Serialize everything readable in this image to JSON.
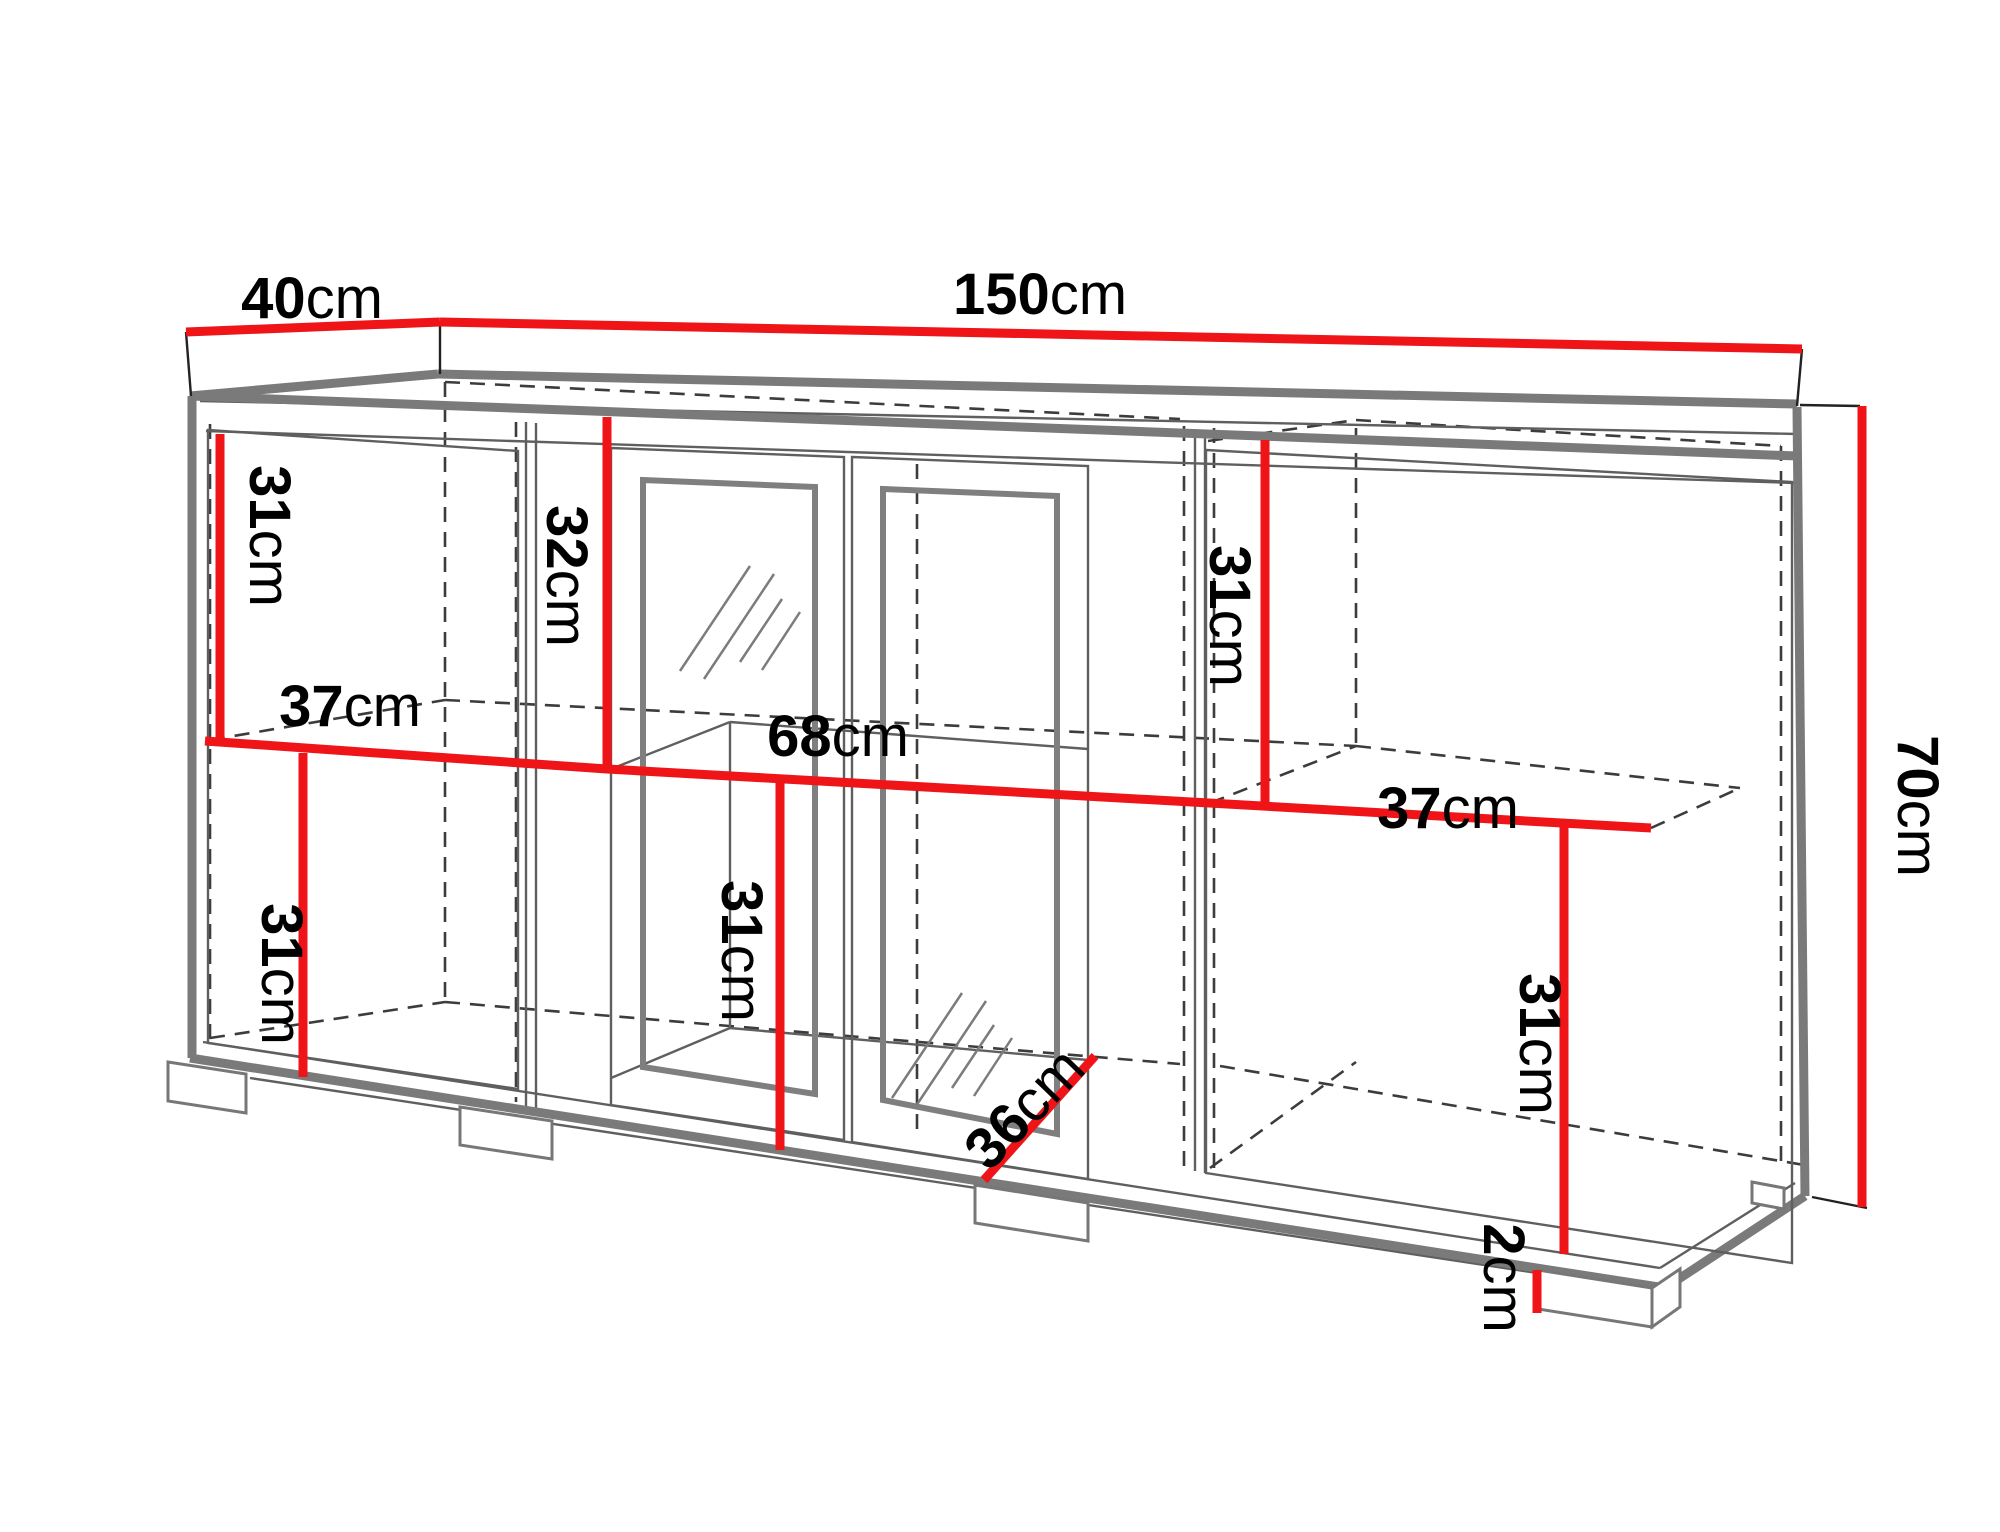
{
  "title": "Sideboard technical dimension diagram 150cm x 40cm x 70cm",
  "canvas": {
    "width": 2000,
    "height": 1500,
    "background": "#ffffff"
  },
  "colors": {
    "red": "#ee1417",
    "gray_thick": "#7a7a7a",
    "gray_thin": "#5f5f5f",
    "frame_thick": "#7f7f7f",
    "dash": "#3c3c3c",
    "tick": "#222222",
    "foot_stroke": "#777777",
    "text": "#000000"
  },
  "stroke": {
    "red_w": 9,
    "thick_w": 9,
    "thin_w": 2.4,
    "dash_w": 2.6,
    "dash_pattern": "15 10",
    "tick_w": 2.4,
    "frame_w": 6,
    "foot_w": 3,
    "font_size": 58
  },
  "dimensions": [
    {
      "id": "depth-top",
      "number": "40",
      "unit": "cm",
      "label": {
        "x": 272,
        "y": 302,
        "rotate": 0,
        "anchor": "middle"
      },
      "lines": [
        [
          146,
          316,
          400,
          306
        ]
      ]
    },
    {
      "id": "width-top",
      "number": "150",
      "unit": "cm",
      "label": {
        "x": 1000,
        "y": 298,
        "rotate": 0,
        "anchor": "middle"
      },
      "lines": [
        [
          400,
          306,
          1762,
          333
        ]
      ]
    },
    {
      "id": "height-right",
      "number": "70",
      "unit": "cm",
      "label": {
        "x": 1878,
        "y": 790,
        "rotate": 90,
        "anchor": "middle"
      },
      "lines": [
        [
          1822,
          390,
          1822,
          1191
        ]
      ]
    },
    {
      "id": "h-left-top",
      "number": "31",
      "unit": "cm",
      "label": {
        "x": 230,
        "y": 520,
        "rotate": 90,
        "anchor": "middle"
      },
      "lines": [
        [
          180,
          418,
          180,
          727
        ]
      ]
    },
    {
      "id": "h-glass-top",
      "number": "32",
      "unit": "cm",
      "label": {
        "x": 527,
        "y": 560,
        "rotate": 90,
        "anchor": "middle"
      },
      "lines": [
        [
          567,
          401,
          567,
          753
        ]
      ]
    },
    {
      "id": "h-right-top",
      "number": "31",
      "unit": "cm",
      "label": {
        "x": 1190,
        "y": 600,
        "rotate": 90,
        "anchor": "middle"
      },
      "lines": [
        [
          1225,
          424,
          1225,
          790
        ]
      ]
    },
    {
      "id": "shelf-left-37",
      "number": "37",
      "unit": "cm",
      "label": {
        "x": 310,
        "y": 710,
        "rotate": 0,
        "anchor": "middle"
      },
      "lines": [],
      "polyline": [
        165,
        725,
        567,
        753,
        1611,
        812
      ]
    },
    {
      "id": "shelf-center-68",
      "number": "68",
      "unit": "cm",
      "label": {
        "x": 798,
        "y": 740,
        "rotate": 0,
        "anchor": "middle"
      },
      "lines": []
    },
    {
      "id": "shelf-right-37",
      "number": "37",
      "unit": "cm",
      "label": {
        "x": 1408,
        "y": 812,
        "rotate": 0,
        "anchor": "middle"
      },
      "lines": []
    },
    {
      "id": "h-left-bottom",
      "number": "31",
      "unit": "cm",
      "label": {
        "x": 242,
        "y": 958,
        "rotate": 90,
        "anchor": "middle"
      },
      "lines": [
        [
          263,
          737,
          263,
          1061
        ]
      ]
    },
    {
      "id": "h-center-bottom",
      "number": "31",
      "unit": "cm",
      "label": {
        "x": 702,
        "y": 935,
        "rotate": 90,
        "anchor": "middle"
      },
      "lines": [
        [
          740,
          766,
          740,
          1134
        ]
      ]
    },
    {
      "id": "h-right-bottom",
      "number": "31",
      "unit": "cm",
      "label": {
        "x": 1500,
        "y": 1028,
        "rotate": 90,
        "anchor": "middle"
      },
      "lines": [
        [
          1524,
          806,
          1524,
          1238
        ]
      ]
    },
    {
      "id": "depth-inner-36",
      "number": "36",
      "unit": "cm",
      "label": {
        "x": 984,
        "y": 1092,
        "rotate": -46,
        "anchor": "middle"
      },
      "lines": [
        [
          944,
          1164,
          1055,
          1040
        ]
      ]
    },
    {
      "id": "foot-height-2",
      "number": "2",
      "unit": "cm",
      "label": {
        "x": 1464,
        "y": 1262,
        "rotate": 90,
        "anchor": "middle"
      },
      "lines": [
        [
          1497,
          1254,
          1497,
          1297
        ]
      ]
    }
  ],
  "structure": {
    "ticks": [
      [
        146,
        316,
        151,
        380
      ],
      [
        400,
        306,
        400,
        358
      ],
      [
        1762,
        333,
        1757,
        390
      ],
      [
        1760,
        389,
        1820,
        390
      ],
      [
        1772,
        1181,
        1827,
        1192
      ]
    ],
    "thick": [
      [
        150,
        380,
        398,
        358
      ],
      [
        398,
        358,
        1757,
        388
      ],
      [
        150,
        380,
        1757,
        440
      ],
      [
        152,
        380,
        152,
        1042
      ],
      [
        1757,
        391,
        1765,
        1180
      ],
      [
        150,
        1042,
        1625,
        1272
      ],
      [
        1765,
        1180,
        1625,
        1272
      ]
    ],
    "thin": [
      [
        160,
        385,
        1757,
        418
      ],
      [
        166,
        415,
        1755,
        467
      ],
      [
        163,
        1026,
        1620,
        1252
      ],
      [
        210,
        1062,
        1497,
        1257
      ],
      [
        1620,
        1252,
        1755,
        1167
      ],
      [
        486,
        406,
        486,
        1090
      ],
      [
        496,
        407,
        496,
        1092
      ],
      [
        1155,
        413,
        1155,
        1155
      ],
      [
        1165,
        414,
        1165,
        1157
      ]
    ],
    "interior": [
      [
        571,
        753,
        690,
        706
      ],
      [
        690,
        706,
        1048,
        733
      ],
      [
        690,
        706,
        690,
        1012
      ],
      [
        571,
        1062,
        690,
        1012
      ],
      [
        690,
        1012,
        1048,
        1044
      ]
    ],
    "dashed": [
      [
        170,
        408,
        170,
        1026
      ],
      [
        405,
        366,
        405,
        988
      ],
      [
        476,
        406,
        476,
        1086
      ],
      [
        877,
        448,
        877,
        1122
      ],
      [
        1144,
        410,
        1144,
        1150
      ],
      [
        1174,
        412,
        1174,
        1156
      ],
      [
        1316,
        412,
        1316,
        728
      ],
      [
        1741,
        430,
        1741,
        1148
      ],
      [
        405,
        366,
        1140,
        403
      ],
      [
        1168,
        425,
        1316,
        404
      ],
      [
        1316,
        404,
        1741,
        430
      ],
      [
        170,
        724,
        405,
        684
      ],
      [
        405,
        684,
        1316,
        730
      ],
      [
        1170,
        787,
        1316,
        730
      ],
      [
        1316,
        730,
        1700,
        772
      ],
      [
        1611,
        812,
        1700,
        772
      ],
      [
        170,
        1022,
        405,
        986
      ],
      [
        405,
        986,
        1140,
        1048
      ],
      [
        1170,
        1152,
        1316,
        1046
      ],
      [
        1180,
        1050,
        1770,
        1150
      ]
    ],
    "door_outlines": [
      [
        168,
        414,
        478,
        435,
        478,
        1073,
        168,
        1027
      ],
      [
        571,
        432,
        804,
        441,
        804,
        1124,
        571,
        1089
      ],
      [
        812,
        441,
        1048,
        450,
        1048,
        1163,
        812,
        1126
      ],
      [
        1166,
        434,
        1752,
        466,
        1752,
        1247,
        1166,
        1157
      ]
    ],
    "door_inner_frames": [
      [
        603,
        464,
        775,
        471,
        775,
        1078,
        603,
        1051
      ],
      [
        843,
        473,
        1017,
        480,
        1017,
        1118,
        843,
        1084
      ]
    ],
    "glass_marks": [
      [
        640,
        655,
        710,
        550
      ],
      [
        664,
        663,
        734,
        558
      ],
      [
        700,
        646,
        742,
        583
      ],
      [
        722,
        654,
        760,
        596
      ],
      [
        852,
        1082,
        922,
        977
      ],
      [
        876,
        1090,
        946,
        985
      ],
      [
        912,
        1072,
        954,
        1009
      ],
      [
        934,
        1080,
        972,
        1022
      ]
    ],
    "feet": [
      [
        128,
        1046,
        206,
        1058,
        206,
        1097,
        128,
        1085
      ],
      [
        420,
        1091,
        512,
        1105,
        512,
        1143,
        420,
        1129
      ],
      [
        935,
        1169,
        1048,
        1187,
        1048,
        1225,
        935,
        1207
      ],
      [
        1498,
        1254,
        1612,
        1272,
        1612,
        1311,
        1498,
        1293
      ],
      [
        1612,
        1272,
        1640,
        1253,
        1640,
        1291,
        1612,
        1311
      ],
      [
        1712,
        1166,
        1744,
        1172,
        1744,
        1193,
        1712,
        1187
      ]
    ]
  }
}
